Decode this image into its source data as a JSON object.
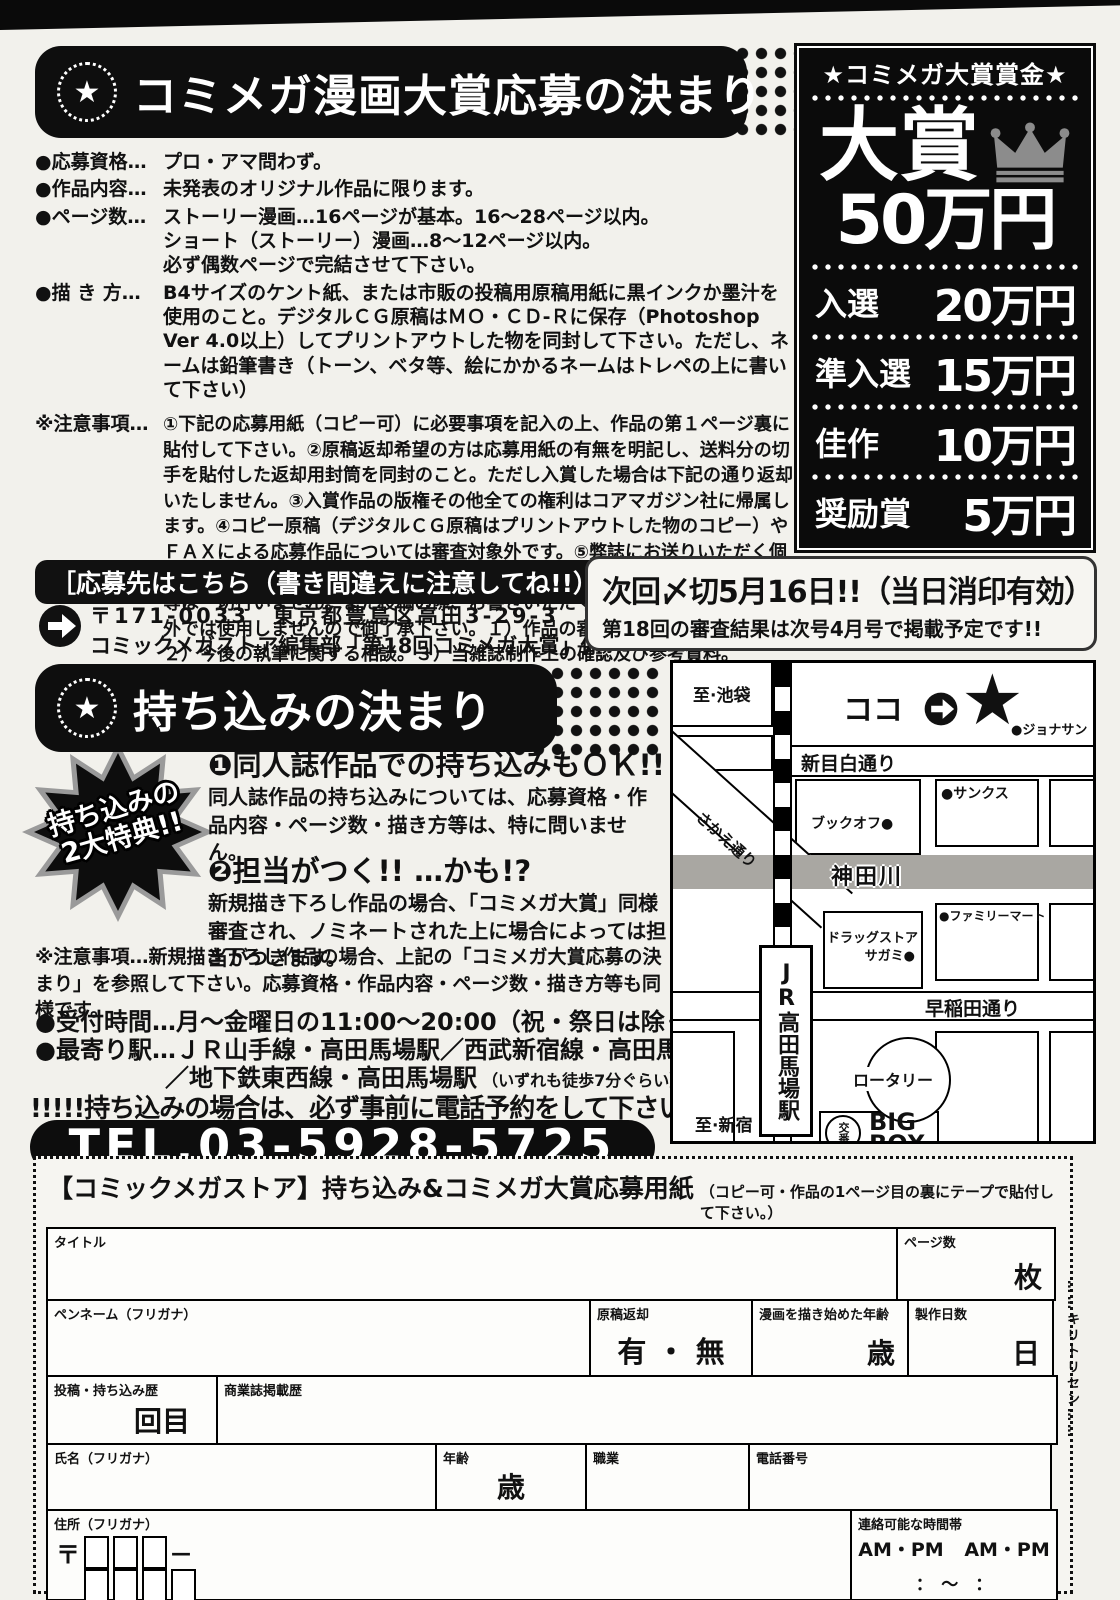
{
  "colors": {
    "ink": "#111111",
    "river_gray": "#a9a7a2",
    "crown_gray": "#8c8c8c"
  },
  "award": {
    "title": "コミメガ漫画大賞応募の決まり",
    "star_glyph": "★",
    "items": [
      {
        "label": "●応募資格…",
        "text": "プロ・アマ問わず。"
      },
      {
        "label": "●作品内容…",
        "text": "未発表のオリジナル作品に限ります。"
      },
      {
        "label": "●ページ数…",
        "lines": [
          "ストーリー漫画…16ページが基本。16〜28ページ以内。",
          "ショート（ストーリー）漫画…8〜12ページ以内。",
          "必ず偶数ページで完結させて下さい。"
        ]
      },
      {
        "label": "●描 き 方…",
        "text": "B4サイズのケント紙、または市販の投稿用原稿用紙に黒インクか墨汁を使用のこと。デジタルＣＧ原稿はＭＯ・ＣＤ-Ｒに保存（Photoshop Ver 4.0以上）してプリントアウトした物を同封して下さい。ただし、ネームは鉛筆書き（トーン、ベタ等、絵にかかるネームはトレペの上に書いて下さい）"
      },
      {
        "label": "※注意事項…",
        "text": "①下記の応募用紙（コピー可）に必要事項を記入の上、作品の第１ページ裏に貼付して下さい。②原稿返却希望の方は応募用紙の有無を明記し、送料分の切手を貼付した返却用封筒を同封のこと。ただし入賞した場合は下記の通り返却いたしません。③入賞作品の版権その他全ての権利はコアマガジン社に帰属します。④コピー原稿（デジタルＣＧ原稿はプリントアウトした物のコピー）やＦＡＸによる応募作品については審査対象外です。⑤弊誌にお送りいただく個人情報は厳重に管理し、投稿者様の承諾を得た場合を除き、第三者提供、開示等は一切行いません。また投稿の際、お書きいただく内容は以下に示す用途以外では使用しませんので御了承下さい。１）作品の審査、返却及び賞の受賞。２）今後の執筆に関する相談。３）当雑誌制作上の確認及び参考資料。"
      }
    ]
  },
  "prizes": {
    "header": "★コミメガ大賞賞金★",
    "grand": {
      "label": "大賞",
      "amount": "50万円"
    },
    "tiers": [
      {
        "label": "入選",
        "amount": "20万円"
      },
      {
        "label": "準入選",
        "amount": "15万円"
      },
      {
        "label": "佳作",
        "amount": "10万円"
      },
      {
        "label": "奨励賞",
        "amount": "5万円"
      }
    ]
  },
  "address": {
    "header": "［応募先はこちら（書き間違えに注意してね!!）］",
    "line1": "〒171-0033　東京都豊島区高田3-29-3　3F",
    "line2": "コミックメガストア編集部「第18回コミメガ大賞」係"
  },
  "deadline": {
    "line1": "次回〆切5月16日!!（当日消印有効）",
    "line2": "第18回の審査結果は次号4月号で掲載予定です!!"
  },
  "walkin": {
    "title": "持ち込みの決まり",
    "badge_line1": "持ち込みの",
    "badge_line2": "2大特典!!",
    "item1_title": "❶同人誌作品での持ち込みもＯＫ!!",
    "item1_text": "同人誌作品の持ち込みについては、応募資格・作品内容・ページ数・描き方等は、特に問いません。",
    "item2_title": "❷担当がつく!! …かも!?",
    "item2_text": "新規描き下ろし作品の場合、「コミメガ大賞」同様審査され、ノミネートされた上に場合によっては担当がつきます。",
    "note_label": "※注意事項",
    "note_text": "…新規描き下ろし作品の場合、上記の「コミメガ大賞応募の決まり」を参照して下さい。応募資格・作品内容・ページ数・描き方等も同様です。",
    "hours": "●受付時間…月〜金曜日の11:00〜20:00（祝・祭日は除く）",
    "station1": "●最寄り駅…ＪＲ山手線・高田馬場駅／西武新宿線・高田馬場駅",
    "station2": "／地下鉄東西線・高田馬場駅",
    "station2_note": "（いずれも徒歩7分ぐらい）",
    "call_notice": "!!!!!持ち込みの場合は、必ず事前に電話予約をして下さい!!!!!",
    "tel": "TEL.03-5928-5725"
  },
  "map": {
    "to_ikebukuro": "至·池袋",
    "koko": "ココ",
    "star": "★",
    "jonathan": "●ジョナサン",
    "shin_mejiro_dori": "新目白通り",
    "sunkus": "●サンクス",
    "bookoff": "ブックオフ●",
    "kandagawa": "神田川",
    "familymart": "●ファミリーマート",
    "sakae_dori": "さかえ通り",
    "station": "JR高田馬場駅",
    "drugstore1": "ドラッグストア",
    "drugstore2": "サガミ●",
    "waseda_dori": "早稲田通り",
    "rotary": "ロータリー",
    "koban": "交番",
    "bigbox1": "BIG",
    "bigbox2": "BOX",
    "to_shinjuku": "至·新宿"
  },
  "form": {
    "title": "【コミックメガストア】持ち込み&コミメガ大賞応募用紙",
    "title_note": "（コピー可・作品の1ページ目の裏にテープで貼付して下さい。）",
    "cutline": "……キリトリセン……",
    "fields": {
      "title_label": "タイトル",
      "pages_label": "ページ数",
      "pages_unit": "枚",
      "penname_label": "ペンネーム（フリガナ）",
      "return_label": "原稿返却",
      "return_value": "有 ・ 無",
      "age_started_label": "漫画を描き始めた年齢",
      "age_started_unit": "歳",
      "days_label": "製作日数",
      "days_unit": "日",
      "history_label": "投稿・持ち込み歴",
      "history_unit": "回目",
      "published_label": "商業誌掲載歴",
      "name_label": "氏名（フリガナ）",
      "age_label": "年齢",
      "age_unit": "歳",
      "job_label": "職業",
      "tel_label": "電話番号",
      "address_label": "住所（フリガナ）",
      "postal_mark": "〒",
      "postal_dash": "—",
      "contact_label": "連絡可能な時間帯",
      "contact_ampm1": "AM・PM",
      "contact_ampm2": "AM・PM",
      "contact_time": "：　〜　："
    }
  }
}
